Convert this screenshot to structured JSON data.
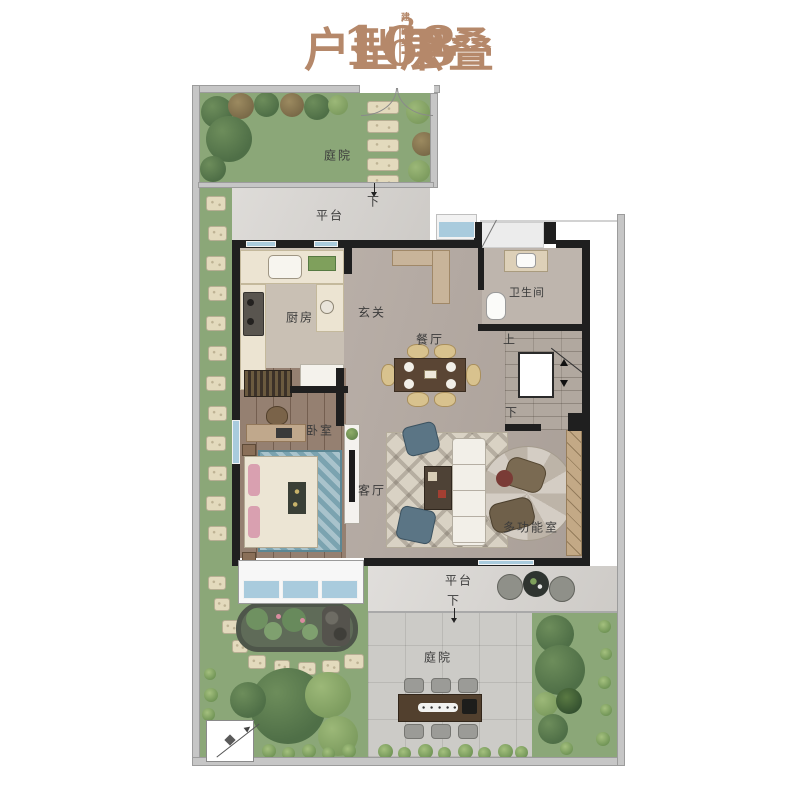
{
  "title": {
    "area": "168",
    "unit_base": "m",
    "unit_sup": "2",
    "area_note": "建面约",
    "product": "户型下叠",
    "floor": "一层"
  },
  "rooms": {
    "courtyard_top": "庭院",
    "platform_top": "平台",
    "step_down_top": "下",
    "kitchen": "厨房",
    "foyer": "玄关",
    "bathroom": "卫生间",
    "dining": "餐厅",
    "stairs_up": "上",
    "stairs_down": "下",
    "bedroom": "卧室",
    "living": "客厅",
    "multi": "多功能室",
    "platform_bottom": "平台",
    "step_down_bottom": "下",
    "courtyard_bottom": "庭院"
  },
  "colors": {
    "accent_title": "#b5886a",
    "lawn": "#8ba778",
    "tree_dark": "#4f6f47",
    "tree_light": "#7d9c5f",
    "marble": "#d6d3cf",
    "floor_tile": "#b4a9a1",
    "wood_floor": "#8d7666",
    "wall": "#1f1f1f",
    "window_blue": "#a9cbdd",
    "stone_path": "#e3dabd",
    "paving": "#cccbc7"
  }
}
